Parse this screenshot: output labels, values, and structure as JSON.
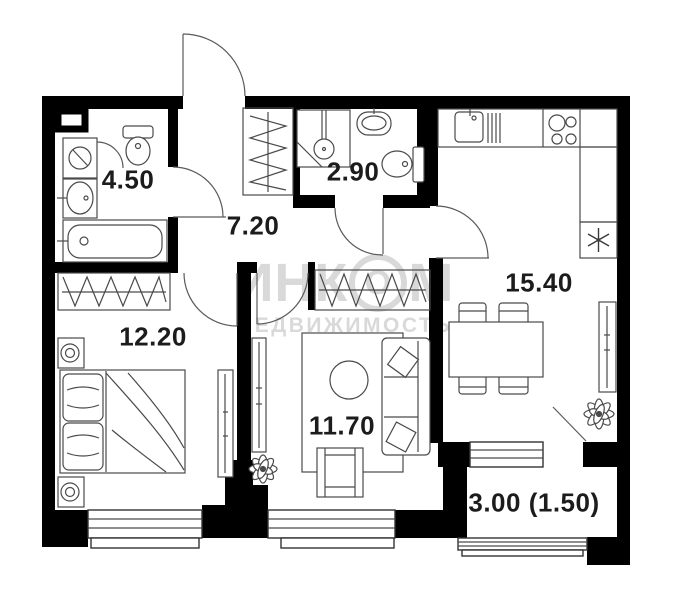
{
  "watermark": {
    "line1_pre": "ИНК",
    "line1_o": "О",
    "line1_post": "М",
    "line2": "НЕДВИЖИМОСТЬ"
  },
  "rooms": [
    {
      "room": "bathroom",
      "area": "4.50"
    },
    {
      "room": "hallway",
      "area": "7.20"
    },
    {
      "room": "shower-wc",
      "area": "2.90"
    },
    {
      "room": "bedroom",
      "area": "12.20"
    },
    {
      "room": "living-room",
      "area": "11.70"
    },
    {
      "room": "kitchen",
      "area": "15.40"
    },
    {
      "room": "balcony",
      "area": "3.00 (1.50)"
    }
  ],
  "colors": {
    "wall": "#000000",
    "fixture_line": "#4a4a4a",
    "label": "#1c1c1c",
    "watermark": "#d9d9d9"
  }
}
